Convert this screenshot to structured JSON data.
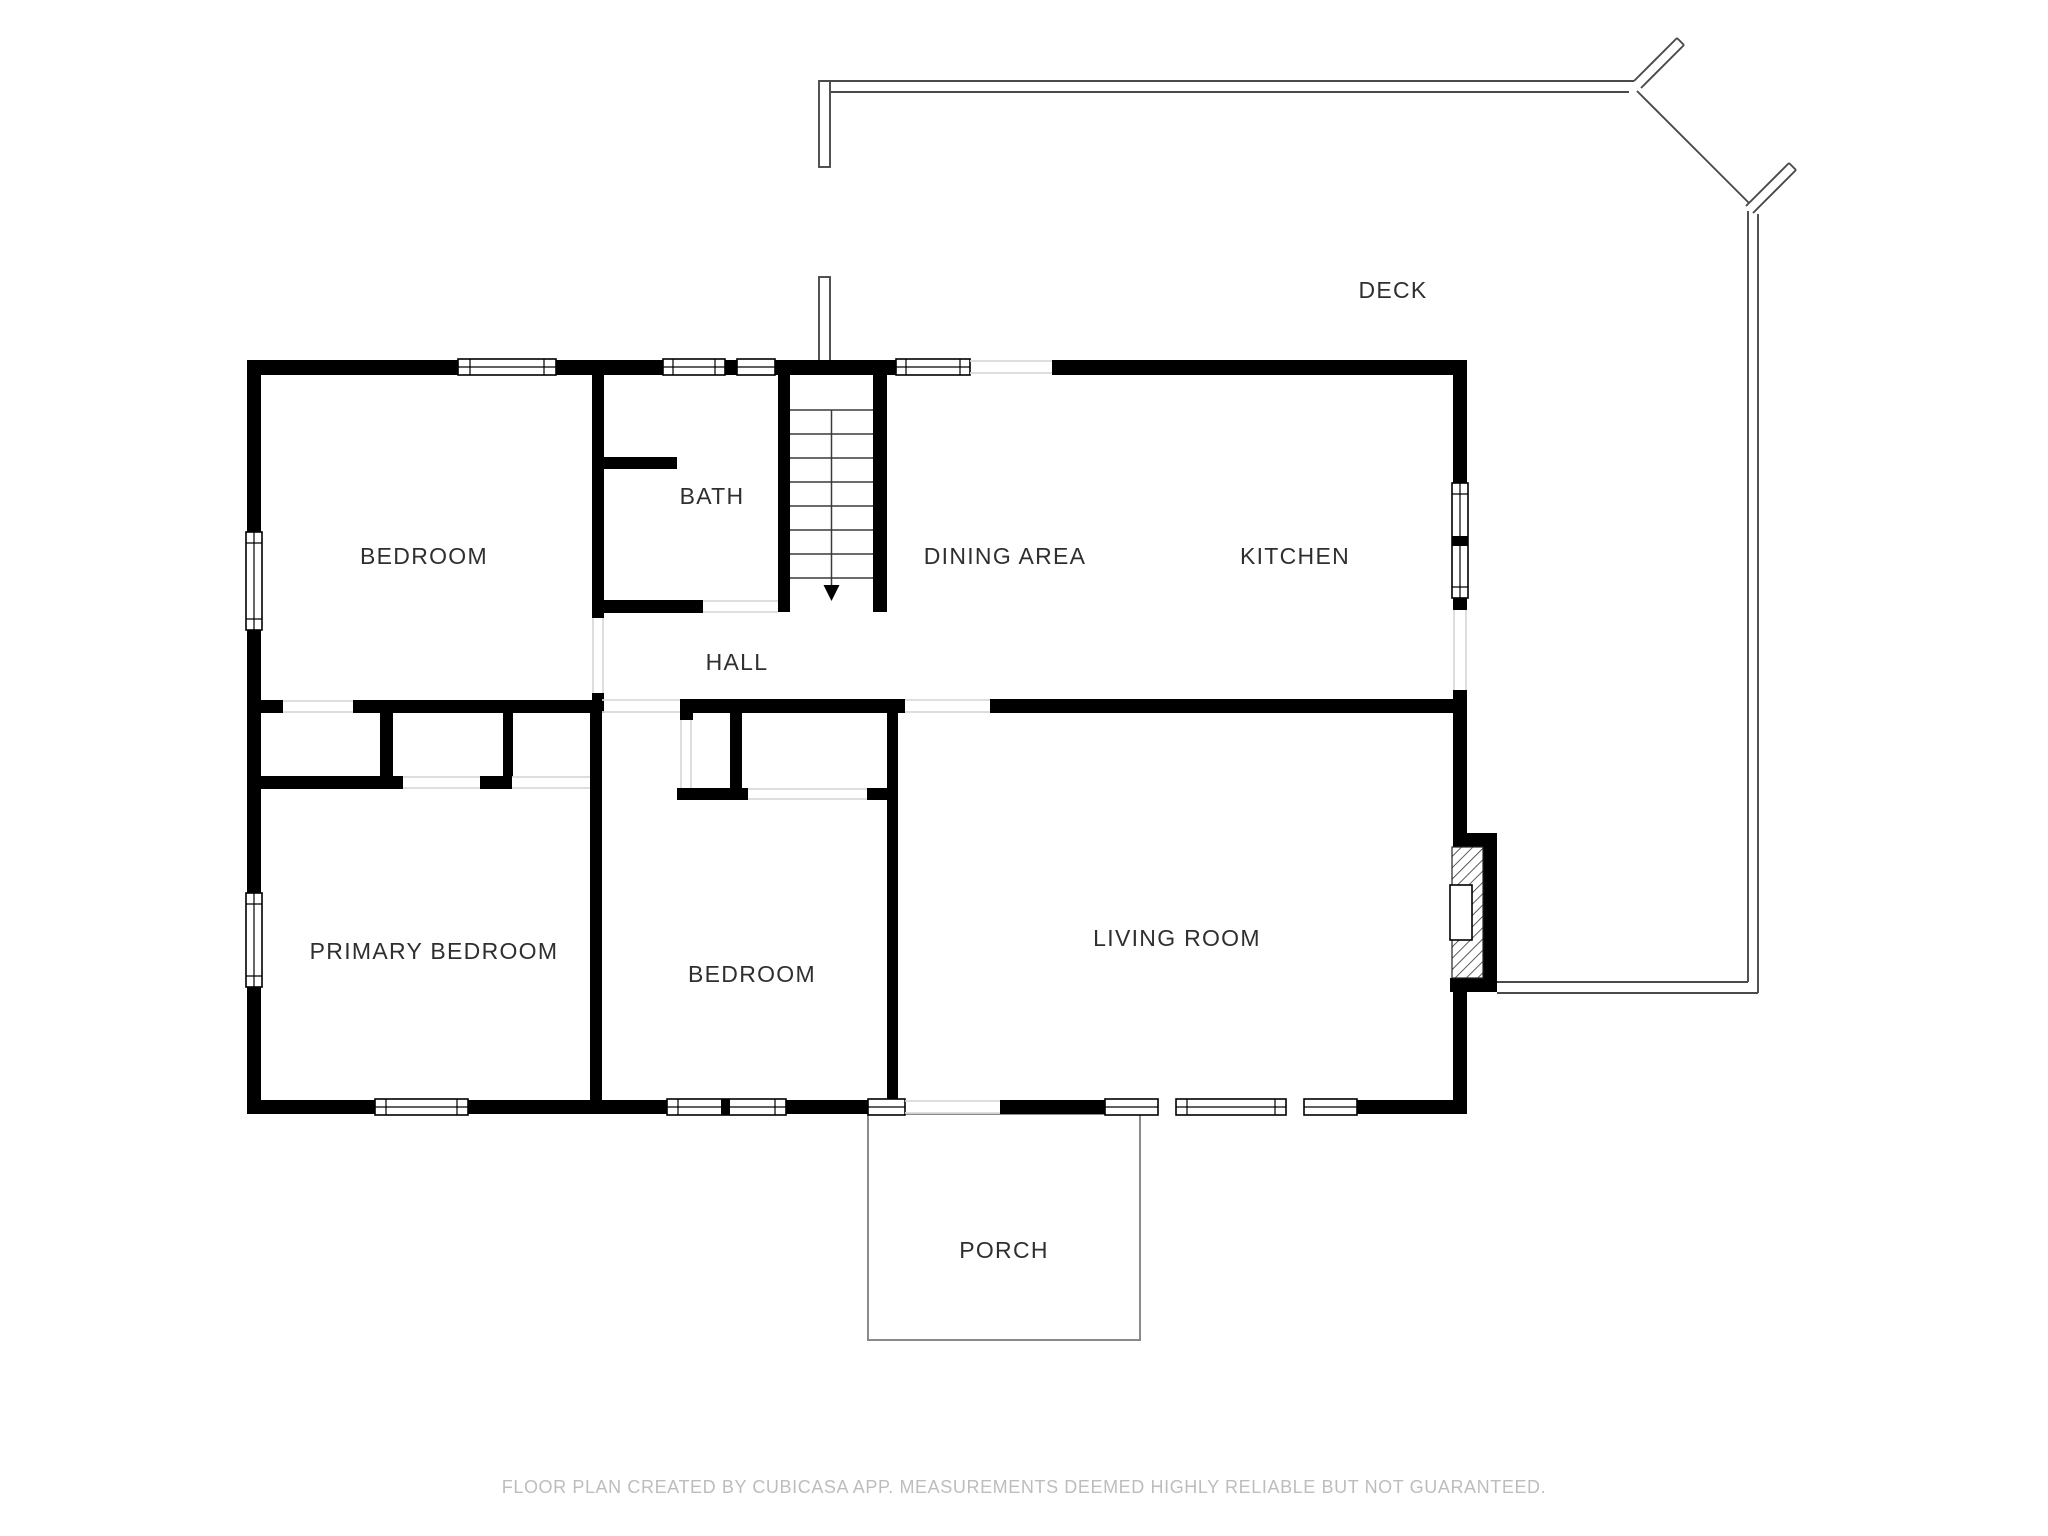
{
  "title": "Floor plan",
  "colors": {
    "background": "#ffffff",
    "wall": "#000000",
    "room_label": "#2f2f2f",
    "footer_text": "#bdbdbd",
    "deck_outline": "#4a4a4a",
    "threshold": "#d9d9d9",
    "porch_outline": "#8a8a8a"
  },
  "rooms": {
    "bedroom_top_left": "BEDROOM",
    "bath": "BATH",
    "dining_area": "DINING AREA",
    "kitchen": "KITCHEN",
    "deck": "DECK",
    "hall": "HALL",
    "primary_bedroom": "PRIMARY BEDROOM",
    "bedroom_bottom": "BEDROOM",
    "living_room": "LIVING ROOM",
    "porch": "PORCH"
  },
  "stairs": {
    "symbol": "staircase-with-down-arrow",
    "tread_count": 8
  },
  "footer": {
    "disclaimer": "FLOOR PLAN CREATED BY CUBICASA APP. MEASUREMENTS DEEMED HIGHLY RELIABLE BUT NOT GUARANTEED."
  }
}
